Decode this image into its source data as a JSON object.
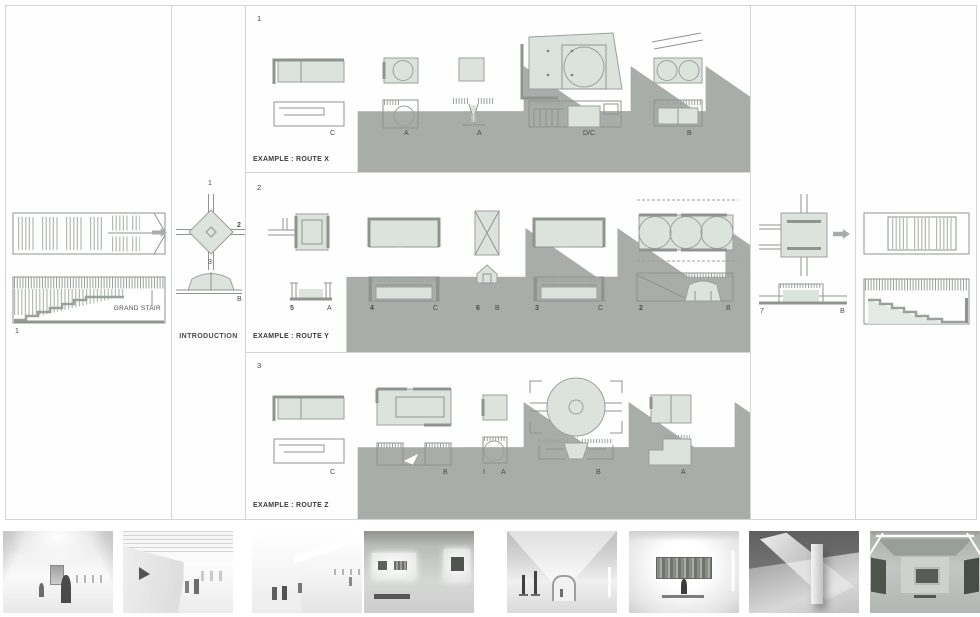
{
  "palette": {
    "diagram_fill": "#dce3dd",
    "wall_gray": "#8f948f",
    "arrow_gray": "#a9ada9",
    "panel_border": "#d5d5d5"
  },
  "left_panel": {
    "number": "1",
    "caption": "GRAND STAIR"
  },
  "intro_panel": {
    "title": "INTRODUCTION",
    "arm_top": "1",
    "arm_right": "2",
    "arm_bottom": "3",
    "section_letter": "B"
  },
  "routes": [
    {
      "number": "1",
      "title": "EXAMPLE : ROUTE X",
      "steps": [
        {
          "letter": "C"
        },
        {
          "letter": "A"
        },
        {
          "letter": "A"
        },
        {
          "letter": "D/C"
        },
        {
          "letter": "B"
        }
      ]
    },
    {
      "number": "2",
      "title": "EXAMPLE : ROUTE Y",
      "steps": [
        {
          "num": "5",
          "letter": "A"
        },
        {
          "num": "4",
          "letter": "C"
        },
        {
          "num": "6",
          "letter": "B"
        },
        {
          "num": "3",
          "letter": "C"
        },
        {
          "num": "2",
          "letter": "B"
        }
      ]
    },
    {
      "number": "3",
      "title": "EXAMPLE : ROUTE Z",
      "steps": [
        {
          "letter": "C"
        },
        {
          "letter": "B"
        },
        {
          "num": "I",
          "letter": "A"
        },
        {
          "letter": "B"
        },
        {
          "letter": "A"
        }
      ]
    }
  ],
  "exit_panel": {
    "number": "7",
    "section_letter": "B"
  },
  "thumbnails": [
    {
      "name": "gallery-entry-with-figures"
    },
    {
      "name": "angled-wall-gallery"
    },
    {
      "name": "ramped-corridor-gallery"
    },
    {
      "name": "alcove-paintings-room"
    },
    {
      "name": "vaulted-sculpture-hall"
    },
    {
      "name": "single-painting-gallery"
    },
    {
      "name": "column-and-light-shaft"
    },
    {
      "name": "coved-ceiling-gallery"
    }
  ]
}
